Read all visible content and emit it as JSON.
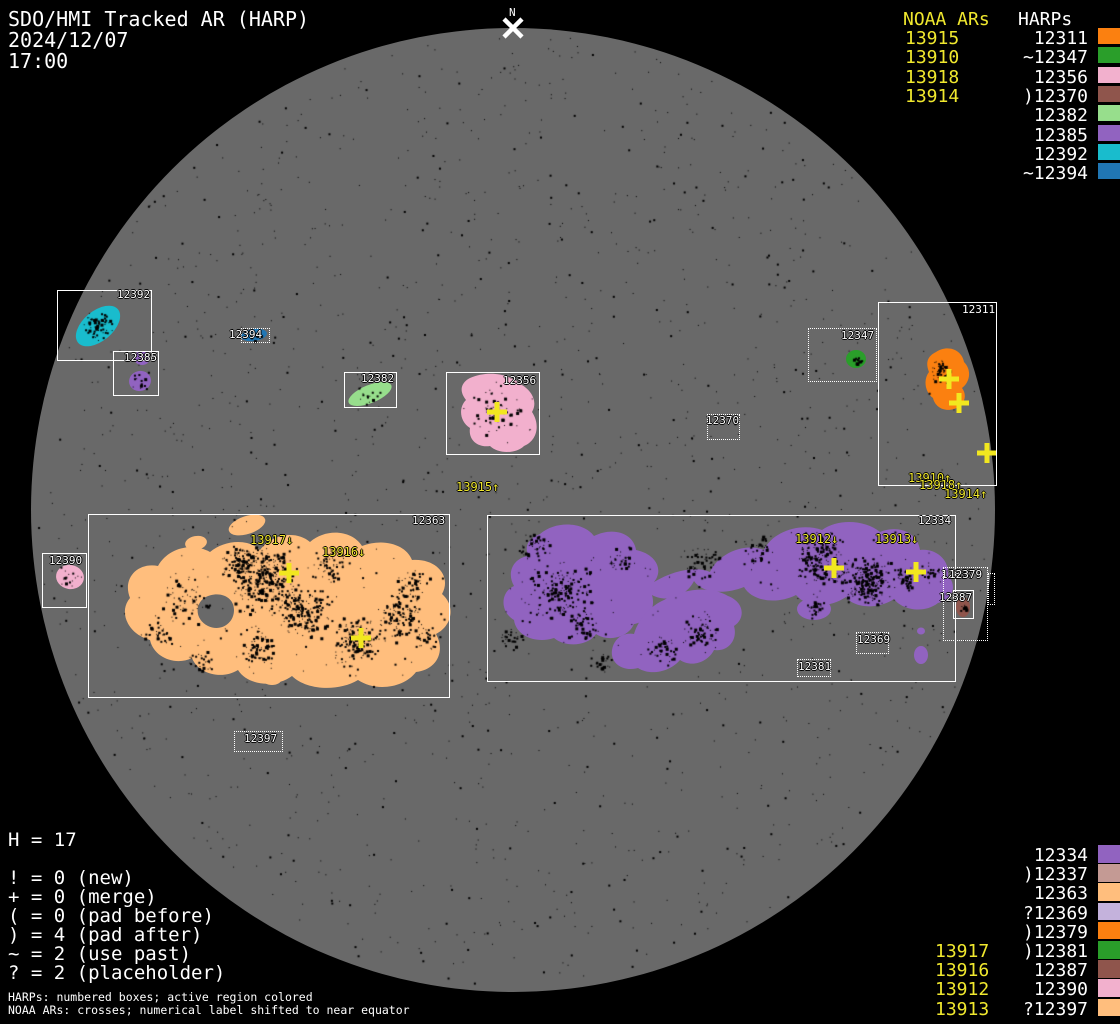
{
  "header": {
    "title": "SDO/HMI Tracked AR (HARP)",
    "date": "2024/12/07",
    "time": "17:00"
  },
  "colors": {
    "background": "#000000",
    "disk": "#696969",
    "text": "#FFFFFF",
    "noaa_yellow": "#F0E82E",
    "cross_yellow": "#F2E71F"
  },
  "panels": {
    "top_right": {
      "noaa_header": "NOAA ARs",
      "harps_header": "HARPs",
      "noaa": [
        "13915",
        "13910",
        "13918",
        "13914"
      ],
      "harps": [
        {
          "label": "12311",
          "color": "#FB8010"
        },
        {
          "label": "~12347",
          "color": "#2A9E2A"
        },
        {
          "label": "12356",
          "color": "#F2B0CD"
        },
        {
          "label": ")12370",
          "color": "#8F554C"
        },
        {
          "label": "12382",
          "color": "#97DE8C"
        },
        {
          "label": "12385",
          "color": "#9163C0"
        },
        {
          "label": "12392",
          "color": "#19BCCD"
        },
        {
          "label": "~12394",
          "color": "#2076B4"
        }
      ]
    },
    "bottom_right": {
      "harps": [
        {
          "label": "12334",
          "color": "#9163C0"
        },
        {
          "label": ")12337",
          "color": "#C49A94"
        },
        {
          "label": "12363",
          "color": "#FFBE7D"
        },
        {
          "label": "?12369",
          "color": "#C4B2DC"
        },
        {
          "label": ")12379",
          "color": "#FB8010"
        },
        {
          "label": ")12381",
          "color": "#2A9E2A"
        },
        {
          "label": "12387",
          "color": "#8F554C"
        },
        {
          "label": "12390",
          "color": "#F2B0CD"
        },
        {
          "label": "?12397",
          "color": "#FFBE7D"
        }
      ],
      "noaa": [
        "13917",
        "13916",
        "13912",
        "13913"
      ]
    }
  },
  "legend": {
    "h_count": "H = 17",
    "items": [
      "! = 0 (new)",
      "+ = 0 (merge)",
      "( = 0 (pad before)",
      ") = 4 (pad after)",
      "~ = 2 (use past)",
      "? = 2 (placeholder)"
    ]
  },
  "footnotes": [
    "HARPs: numbered boxes; active region colored",
    "NOAA ARs: crosses; numerical label shifted to near equator"
  ],
  "chart_data": {
    "type": "scatter",
    "title": "SDO/HMI Tracked AR (HARP)",
    "datetime": "2024/12/07 17:00",
    "disk": {
      "cx": 513,
      "cy": 510,
      "r": 482
    },
    "north_marker": {
      "label": "N",
      "x": 513,
      "y": 28
    },
    "harp_boxes": [
      {
        "id": "12392",
        "style": "solid",
        "x": 57,
        "y": 290,
        "w": 95,
        "h": 71,
        "label": {
          "x": 117,
          "y": 289
        }
      },
      {
        "id": "12385",
        "style": "solid",
        "x": 113,
        "y": 351,
        "w": 46,
        "h": 45,
        "label": {
          "x": 124,
          "y": 352
        }
      },
      {
        "id": "12394",
        "style": "dotted",
        "x": 241,
        "y": 328,
        "w": 29,
        "h": 15,
        "label": {
          "x": 229,
          "y": 329
        }
      },
      {
        "id": "12382",
        "style": "solid",
        "x": 344,
        "y": 372,
        "w": 53,
        "h": 36,
        "label": {
          "x": 361,
          "y": 373
        }
      },
      {
        "id": "12356",
        "style": "solid",
        "x": 446,
        "y": 372,
        "w": 94,
        "h": 83,
        "label": {
          "x": 503,
          "y": 375
        }
      },
      {
        "id": "12347",
        "style": "dotted",
        "x": 808,
        "y": 328,
        "w": 69,
        "h": 54,
        "label": {
          "x": 841,
          "y": 330
        }
      },
      {
        "id": "12311",
        "style": "solid",
        "x": 878,
        "y": 302,
        "w": 119,
        "h": 184,
        "label": {
          "x": 962,
          "y": 304
        }
      },
      {
        "id": "12370",
        "style": "dotted",
        "x": 707,
        "y": 414,
        "w": 33,
        "h": 26,
        "label": {
          "x": 706,
          "y": 415
        }
      },
      {
        "id": "12390",
        "style": "solid",
        "x": 42,
        "y": 553,
        "w": 45,
        "h": 55,
        "label": {
          "x": 49,
          "y": 555
        }
      },
      {
        "id": "12363",
        "style": "solid",
        "x": 88,
        "y": 514,
        "w": 362,
        "h": 184,
        "label": {
          "x": 412,
          "y": 515
        }
      },
      {
        "id": "12334",
        "style": "solid",
        "x": 487,
        "y": 515,
        "w": 469,
        "h": 167,
        "label": {
          "x": 918,
          "y": 515
        }
      },
      {
        "id": "12337",
        "style": "dotted",
        "x": 988,
        "y": 573,
        "w": 7,
        "h": 32,
        "label": {
          "x": 941,
          "y": 569
        }
      },
      {
        "id": "12379",
        "style": "dotted",
        "x": 943,
        "y": 567,
        "w": 45,
        "h": 74,
        "label": {
          "x": 949,
          "y": 569
        }
      },
      {
        "id": "12387",
        "style": "solid",
        "x": 953,
        "y": 590,
        "w": 21,
        "h": 29,
        "label": {
          "x": 939,
          "y": 592
        }
      },
      {
        "id": "12369",
        "style": "dotted",
        "x": 856,
        "y": 632,
        "w": 33,
        "h": 22,
        "label": {
          "x": 857,
          "y": 634
        }
      },
      {
        "id": "12381",
        "style": "dotted",
        "x": 797,
        "y": 659,
        "w": 34,
        "h": 18,
        "label": {
          "x": 798,
          "y": 661
        }
      },
      {
        "id": "12397",
        "style": "dotted",
        "x": 234,
        "y": 731,
        "w": 49,
        "h": 21,
        "label": {
          "x": 244,
          "y": 733
        }
      }
    ],
    "regions": [
      {
        "harp": "12392",
        "color": "#19BCCD",
        "shape": "ellipse",
        "cx": 98,
        "cy": 326,
        "rx": 26,
        "ry": 15,
        "rot": -40
      },
      {
        "harp": "12385",
        "color": "#9163C0",
        "shape": "ellipse",
        "cx": 142,
        "cy": 358,
        "rx": 8,
        "ry": 7,
        "rot": 0
      },
      {
        "harp": "12385",
        "color": "#9163C0",
        "shape": "ellipse",
        "cx": 140,
        "cy": 381,
        "rx": 11,
        "ry": 10,
        "rot": -15
      },
      {
        "harp": "12394",
        "color": "#2076B4",
        "shape": "ellipse",
        "cx": 254,
        "cy": 335,
        "rx": 13,
        "ry": 6,
        "rot": -8
      },
      {
        "harp": "12382",
        "color": "#97DE8C",
        "shape": "ellipse",
        "cx": 370,
        "cy": 394,
        "rx": 23,
        "ry": 9,
        "rot": -22
      },
      {
        "harp": "12356",
        "color": "#F2B0CD",
        "shape": "path",
        "d": "M 470,378 C 488,370 510,374 520,384 C 532,390 538,402 532,412 C 540,424 538,440 524,446 C 516,454 498,454 490,446 C 478,448 468,440 470,428 C 460,422 458,408 466,400 C 458,390 462,382 470,378 Z"
      },
      {
        "harp": "12347",
        "color": "#2A9E2A",
        "shape": "ellipse",
        "cx": 856,
        "cy": 359,
        "rx": 10,
        "ry": 9,
        "rot": 0
      },
      {
        "harp": "12311",
        "color": "#FB8010",
        "shape": "path",
        "d": "M 936,352 C 948,344 962,350 964,362 C 972,370 970,382 962,388 C 968,396 964,406 954,409 C 944,412 935,407 933,398 C 925,392 923,380 929,372 C 925,362 928,356 936,352 Z"
      },
      {
        "harp": "12390",
        "color": "#F2B0CD",
        "shape": "ellipse",
        "cx": 70,
        "cy": 577,
        "rx": 14,
        "ry": 12,
        "rot": 10
      },
      {
        "harp": "12387",
        "color": "#8F554C",
        "shape": "ellipse",
        "cx": 963,
        "cy": 607,
        "rx": 7,
        "ry": 10,
        "rot": 0
      },
      {
        "harp": "12363",
        "color": "#FFBE7D",
        "shape": "path",
        "fillRule": "evenodd",
        "d": "M 150,640 C 128,634 118,612 130,598 C 122,578 138,562 158,566 C 168,548 192,542 210,552 C 224,540 248,538 260,550 C 272,534 296,530 310,542 C 326,528 352,530 362,546 C 382,538 406,544 412,560 C 436,558 452,576 442,594 C 456,606 452,626 436,634 C 446,652 436,670 416,672 C 404,688 376,692 358,680 C 338,692 306,690 292,676 C 276,688 248,686 238,670 C 222,680 198,674 192,658 C 176,666 154,658 150,640 Z M 204,598 C 218,590 234,596 234,610 C 234,624 220,632 208,626 C 196,620 194,606 204,598 Z"
      },
      {
        "harp": "12363",
        "color": "#FFBE7D",
        "shape": "ellipse",
        "cx": 247,
        "cy": 525,
        "rx": 19,
        "ry": 9,
        "rot": -18
      },
      {
        "harp": "12363",
        "color": "#FFBE7D",
        "shape": "ellipse",
        "cx": 196,
        "cy": 543,
        "rx": 11,
        "ry": 7,
        "rot": -10
      },
      {
        "harp": "12363",
        "color": "#FFBE7D",
        "shape": "ellipse",
        "cx": 272,
        "cy": 680,
        "rx": 9,
        "ry": 5,
        "rot": 0
      },
      {
        "harp": "12334",
        "color": "#9163C0",
        "shape": "path",
        "d": "M 540,534 C 556,520 584,522 594,536 C 614,526 634,534 636,550 C 656,554 664,570 654,582 C 674,570 696,566 710,572 C 718,554 744,542 764,550 C 772,532 800,522 822,530 C 838,518 866,520 880,532 C 900,524 918,534 920,550 C 936,548 950,560 948,576 C 958,586 952,600 938,603 C 924,614 902,610 894,599 C 878,610 854,608 846,597 C 828,609 806,607 796,595 C 776,605 752,601 744,587 C 724,595 702,593 694,581 C 686,597 666,603 652,595 C 656,609 648,622 634,624 C 628,638 608,642 596,634 C 588,646 566,648 554,638 C 536,644 516,636 514,620 C 500,612 500,592 514,586 C 506,572 514,558 528,556 C 524,544 530,538 540,534 Z"
      },
      {
        "harp": "12334",
        "color": "#9163C0",
        "shape": "path",
        "d": "M 728,596 C 744,602 746,618 734,626 C 738,640 728,652 714,650 C 708,662 692,668 680,660 C 670,672 650,676 638,668 C 624,672 610,664 612,650 C 614,638 624,632 634,634 C 638,620 650,606 664,600 C 684,588 712,586 728,596 Z"
      },
      {
        "harp": "12334",
        "color": "#9163C0",
        "shape": "ellipse",
        "cx": 814,
        "cy": 609,
        "rx": 17,
        "ry": 11,
        "rot": 0
      },
      {
        "harp": "12334",
        "color": "#9163C0",
        "shape": "ellipse",
        "cx": 921,
        "cy": 631,
        "rx": 4,
        "ry": 3.5,
        "rot": 0
      },
      {
        "harp": "12334",
        "color": "#9163C0",
        "shape": "ellipse",
        "cx": 921,
        "cy": 655,
        "rx": 7,
        "ry": 9,
        "rot": 0
      }
    ],
    "noaa_crosses": [
      {
        "x": 497,
        "y": 412
      },
      {
        "x": 949,
        "y": 379
      },
      {
        "x": 959,
        "y": 403
      },
      {
        "x": 987,
        "y": 453
      },
      {
        "x": 289,
        "y": 573
      },
      {
        "x": 361,
        "y": 638
      },
      {
        "x": 834,
        "y": 568
      },
      {
        "x": 916,
        "y": 572
      }
    ],
    "noaa_disk_labels": [
      {
        "text": "13915↑",
        "x": 456,
        "y": 481
      },
      {
        "text": "13910↑",
        "x": 908,
        "y": 472
      },
      {
        "text": "13918↑",
        "x": 919,
        "y": 479
      },
      {
        "text": "13914↑",
        "x": 944,
        "y": 488
      },
      {
        "text": "13917↓",
        "x": 250,
        "y": 534
      },
      {
        "text": "13916↓",
        "x": 322,
        "y": 546
      },
      {
        "text": "13912↓",
        "x": 795,
        "y": 533
      },
      {
        "text": "13913↓",
        "x": 875,
        "y": 533
      }
    ]
  }
}
